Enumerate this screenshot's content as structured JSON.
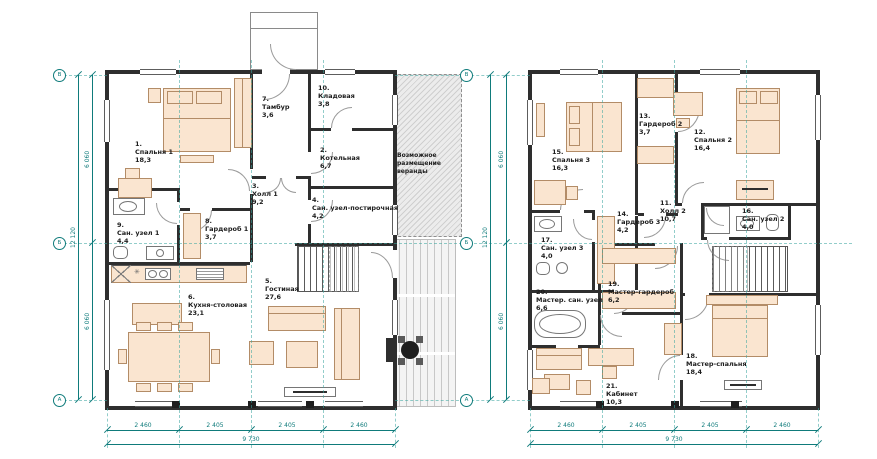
{
  "axis_bubbles": [
    "В",
    "Б",
    "А"
  ],
  "veranda_note": "Возможное размещение веранды",
  "icons": {
    "kitchen_star": "✳"
  },
  "colors": {
    "dimension": "#0f7b7b",
    "wall": "#2e2e2e",
    "furniture_fill": "#fae5d0",
    "furniture_stroke": "#b38c67",
    "grid_dash": "#3aa6a0"
  },
  "dimensions": {
    "bottom_segments": [
      "2 460",
      "2 405",
      "2 405",
      "2 460"
    ],
    "bottom_total": "9 730",
    "side_segments": [
      "6 060",
      "6 060"
    ],
    "side_total": "12 120"
  },
  "plans": {
    "first": {
      "rooms": [
        {
          "num": "1.",
          "name": "Спальня 1",
          "area": "18,3"
        },
        {
          "num": "7.",
          "name": "Тамбур",
          "area": "3,6"
        },
        {
          "num": "10.",
          "name": "Кладовая",
          "area": "3,8"
        },
        {
          "num": "2.",
          "name": "Котельная",
          "area": "6,7"
        },
        {
          "num": "3.",
          "name": "Холл 1",
          "area": "9,2"
        },
        {
          "num": "4.",
          "name": "Сан. узел-постирочная",
          "area": "4,2"
        },
        {
          "num": "9.",
          "name": "Сан. узел 1",
          "area": "4,4"
        },
        {
          "num": "8.",
          "name": "Гардероб 1",
          "area": "3,7"
        },
        {
          "num": "5.",
          "name": "Гостиная",
          "area": "27,6"
        },
        {
          "num": "6.",
          "name": "Кухня-столовая",
          "area": "23,1"
        }
      ]
    },
    "second": {
      "rooms": [
        {
          "num": "15.",
          "name": "Спальня 3",
          "area": "16,3"
        },
        {
          "num": "13.",
          "name": "Гардероб 2",
          "area": "3,7"
        },
        {
          "num": "12.",
          "name": "Спальня 2",
          "area": "16,4"
        },
        {
          "num": "11.",
          "name": "Холл 2",
          "area": "10,7"
        },
        {
          "num": "14.",
          "name": "Гардероб 3",
          "area": "4,2"
        },
        {
          "num": "17.",
          "name": "Сан. узел 3",
          "area": "4,0"
        },
        {
          "num": "16.",
          "name": "Сан. узел 2",
          "area": "4,0"
        },
        {
          "num": "20.",
          "name": "Мастер. сан. узел",
          "area": "6,6"
        },
        {
          "num": "19.",
          "name": "Мастер-гардероб",
          "area": "6,2"
        },
        {
          "num": "21.",
          "name": "Кабинет",
          "area": "10,3"
        },
        {
          "num": "18.",
          "name": "Мастер-спальня",
          "area": "18,4"
        }
      ]
    }
  }
}
